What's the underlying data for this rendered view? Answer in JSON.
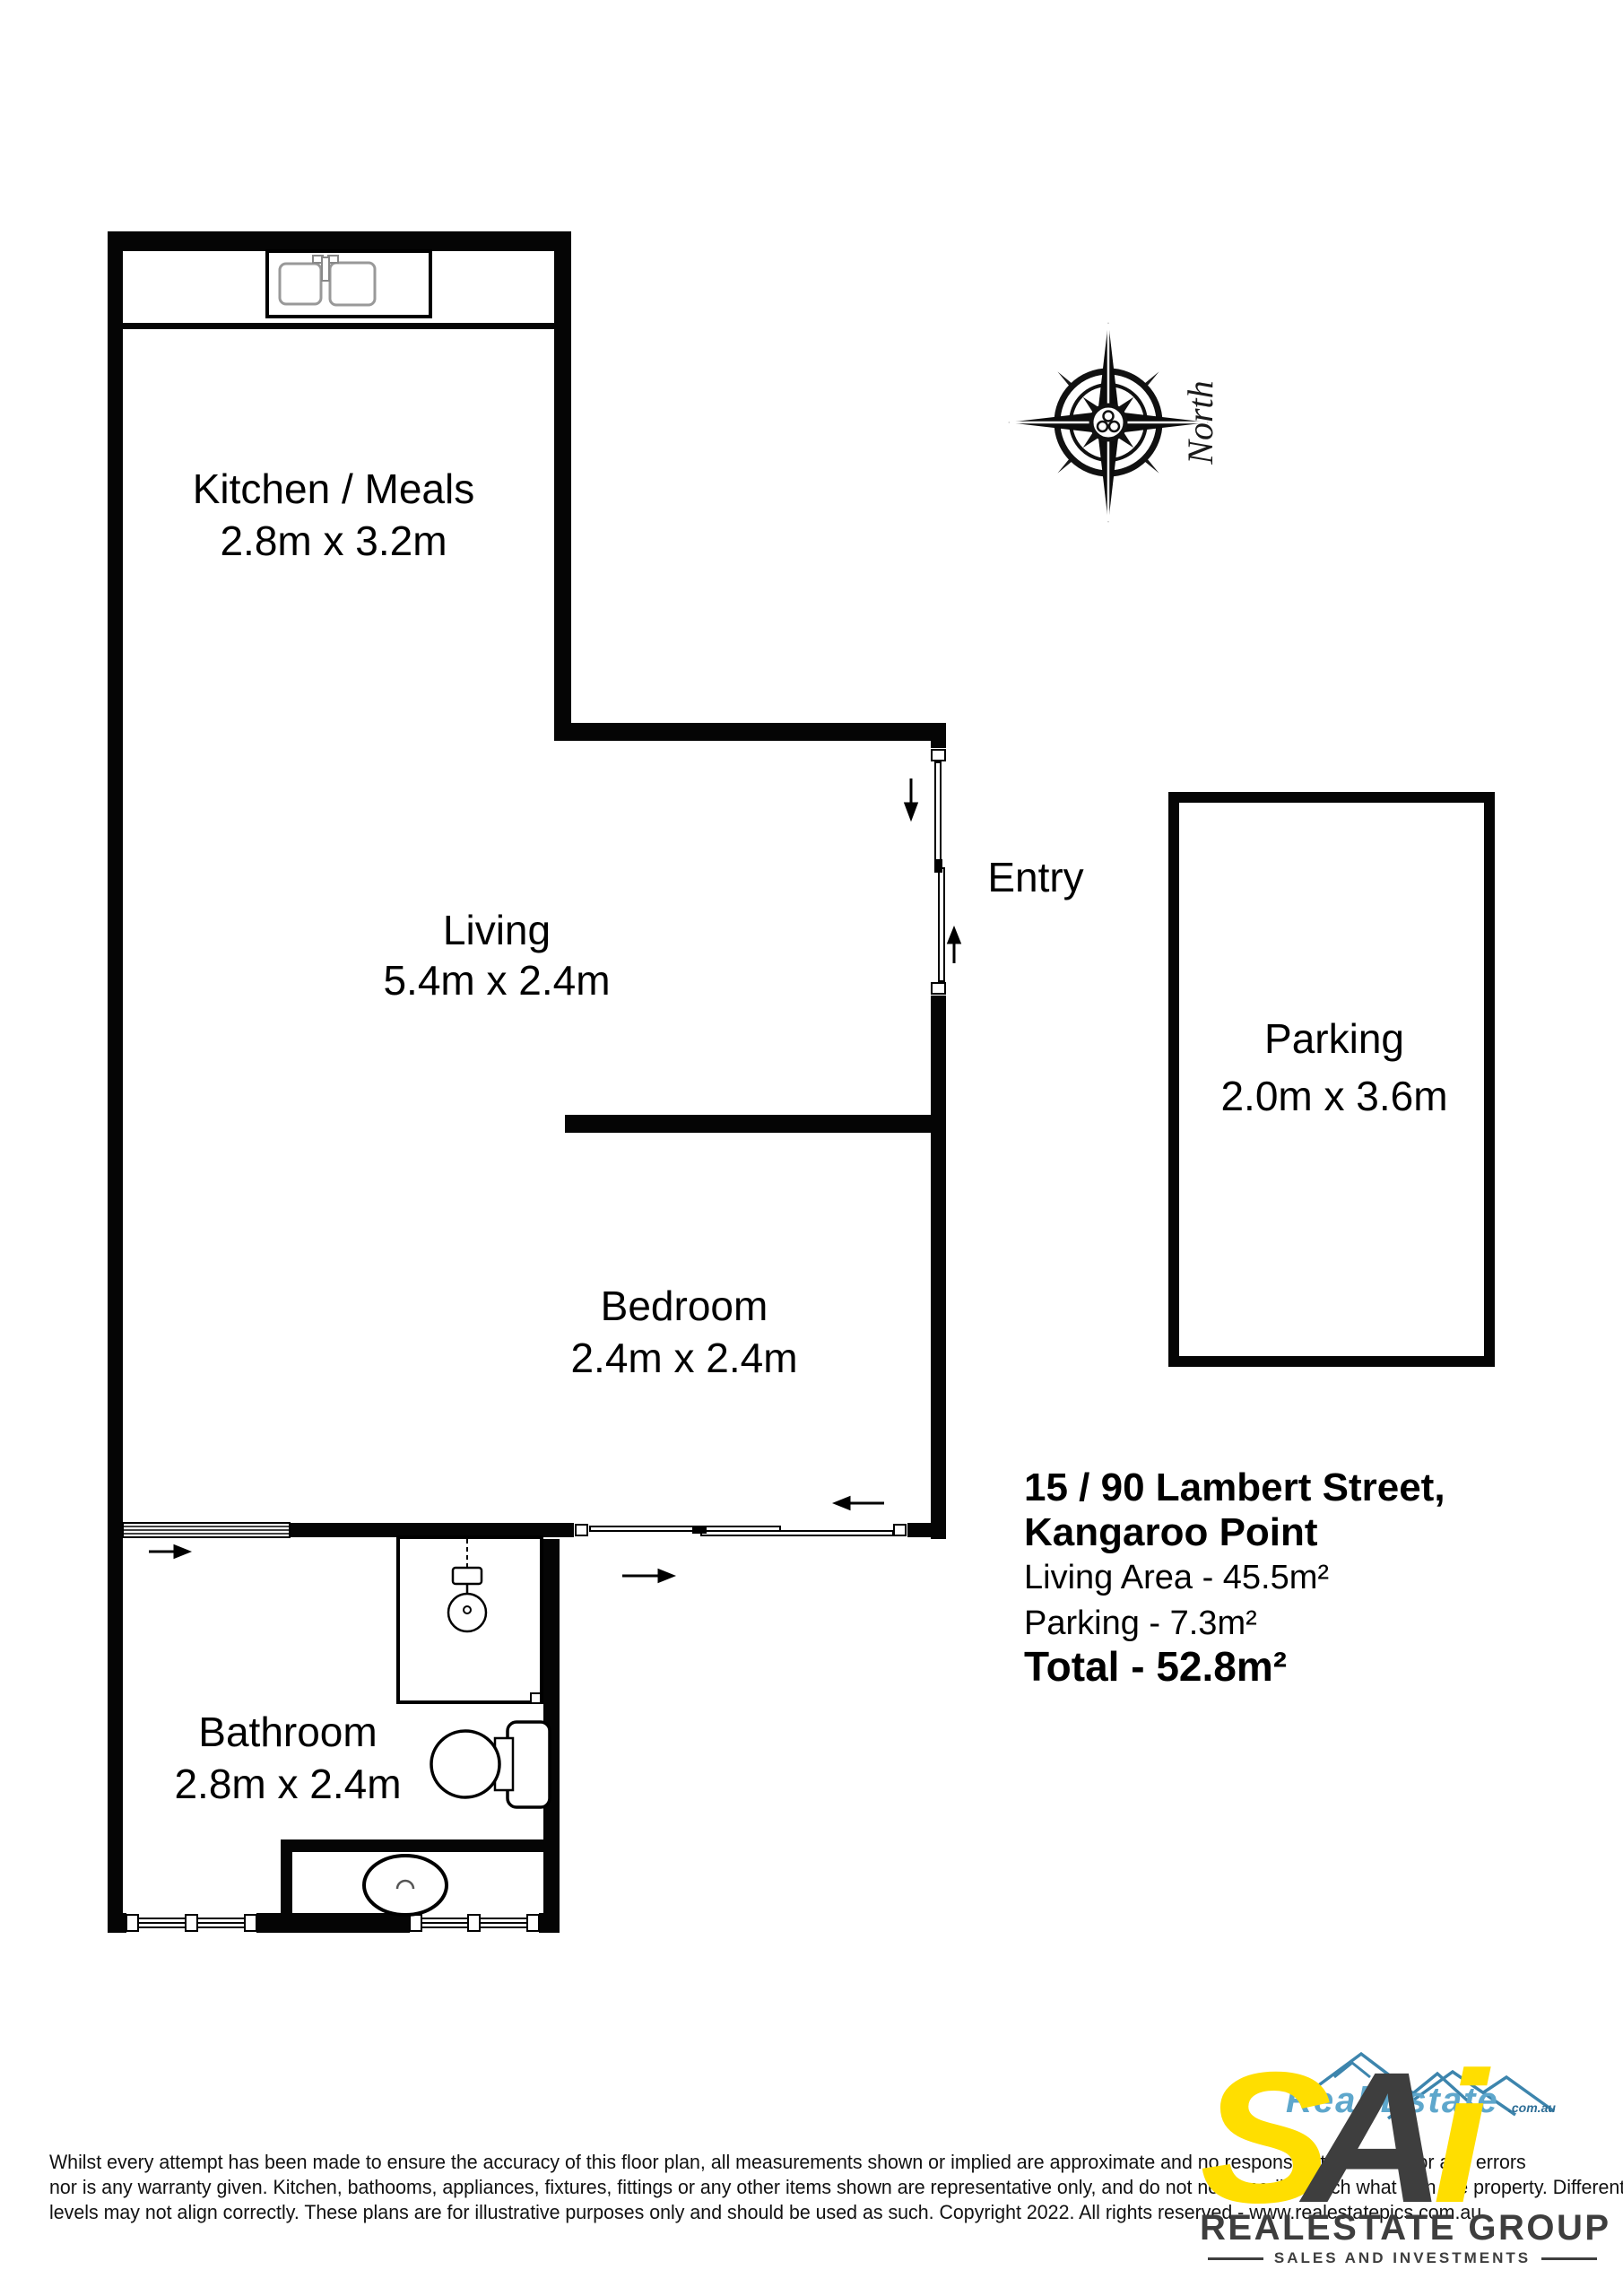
{
  "floor_plan": {
    "rooms": {
      "kitchen": {
        "name": "Kitchen / Meals",
        "dims": "2.8m x 3.2m"
      },
      "living": {
        "name": "Living",
        "dims": "5.4m x 2.4m"
      },
      "bedroom": {
        "name": "Bedroom",
        "dims": "2.4m x 2.4m"
      },
      "bathroom": {
        "name": "Bathroom",
        "dims": "2.8m x 2.4m"
      },
      "entry": {
        "name": "Entry"
      },
      "parking": {
        "name": "Parking",
        "dims": "2.0m x 3.6m"
      }
    },
    "compass": {
      "label": "North"
    }
  },
  "summary": {
    "address_line1": "15 / 90 Lambert Street,",
    "address_line2": "Kangaroo Point",
    "living_area": "Living Area - 45.5m²",
    "parking_area": "Parking - 7.3m²",
    "total": "Total - 52.8m²"
  },
  "disclaimer": {
    "line1": "Whilst every attempt has been made to ensure the accuracy of this floor plan, all measurements shown or implied are approximate and no responsibility is taken for any errors",
    "line2": "nor is any warranty given.  Kitchen, bathooms, appliances, fixtures, fittings or any  other items shown  are representative only, and do not necessarily match what is in the property.  Different",
    "line3": "levels may not align correctly.  These plans are for illustrative purposes only and should be used as such.  Copyright 2022.  All rights reserved - www.realestatepics.com.au"
  },
  "logo": {
    "letter_s": "S",
    "letter_a": "A",
    "letter_i": "i",
    "watermark": "Real Estate",
    "watermark_domain": ".com.au",
    "group_name": "REALESTATE GROUP",
    "tagline": "SALES AND INVESTMENTS",
    "colors": {
      "yellow": "#FFDE00",
      "charcoal": "#3E3E3E",
      "blue": "#3D85AD"
    }
  }
}
